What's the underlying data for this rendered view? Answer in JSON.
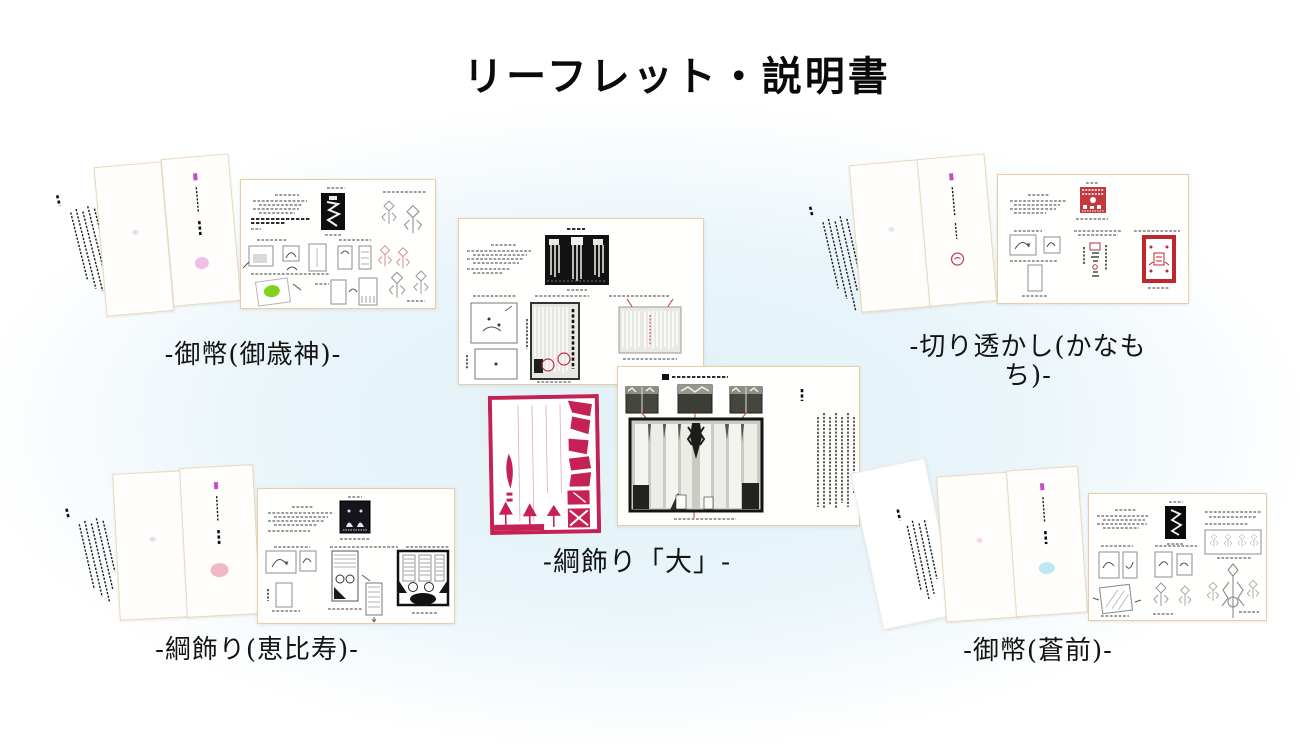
{
  "page": {
    "title": "リーフレット・説明書"
  },
  "groups": [
    {
      "id": "gohei-mitoshigami",
      "label": "-御幣(御歳神)-"
    },
    {
      "id": "kirisukashi-kanamochi",
      "label": "-切り透かし(かなもち)-"
    },
    {
      "id": "tsunakazari-dai",
      "label": "-綱飾り「大」-"
    },
    {
      "id": "tsunakazari-ebisu",
      "label": "-綱飾り(恵比寿)-"
    },
    {
      "id": "gohei-souzen",
      "label": "-御幣(蒼前)-"
    }
  ],
  "colors": {
    "background_tint": "#e6f3f8",
    "sheet_border": "#e8cda5",
    "papercut_red": "#c62155",
    "stamp_red": "#c23a40",
    "accent_magenta": "#c44fc4",
    "cover_dot_pink": "#efaede",
    "cover_dot_rose": "#edacbe",
    "cover_dot_cyan": "#b5e6ef",
    "diagram_green": "#7ed321"
  }
}
